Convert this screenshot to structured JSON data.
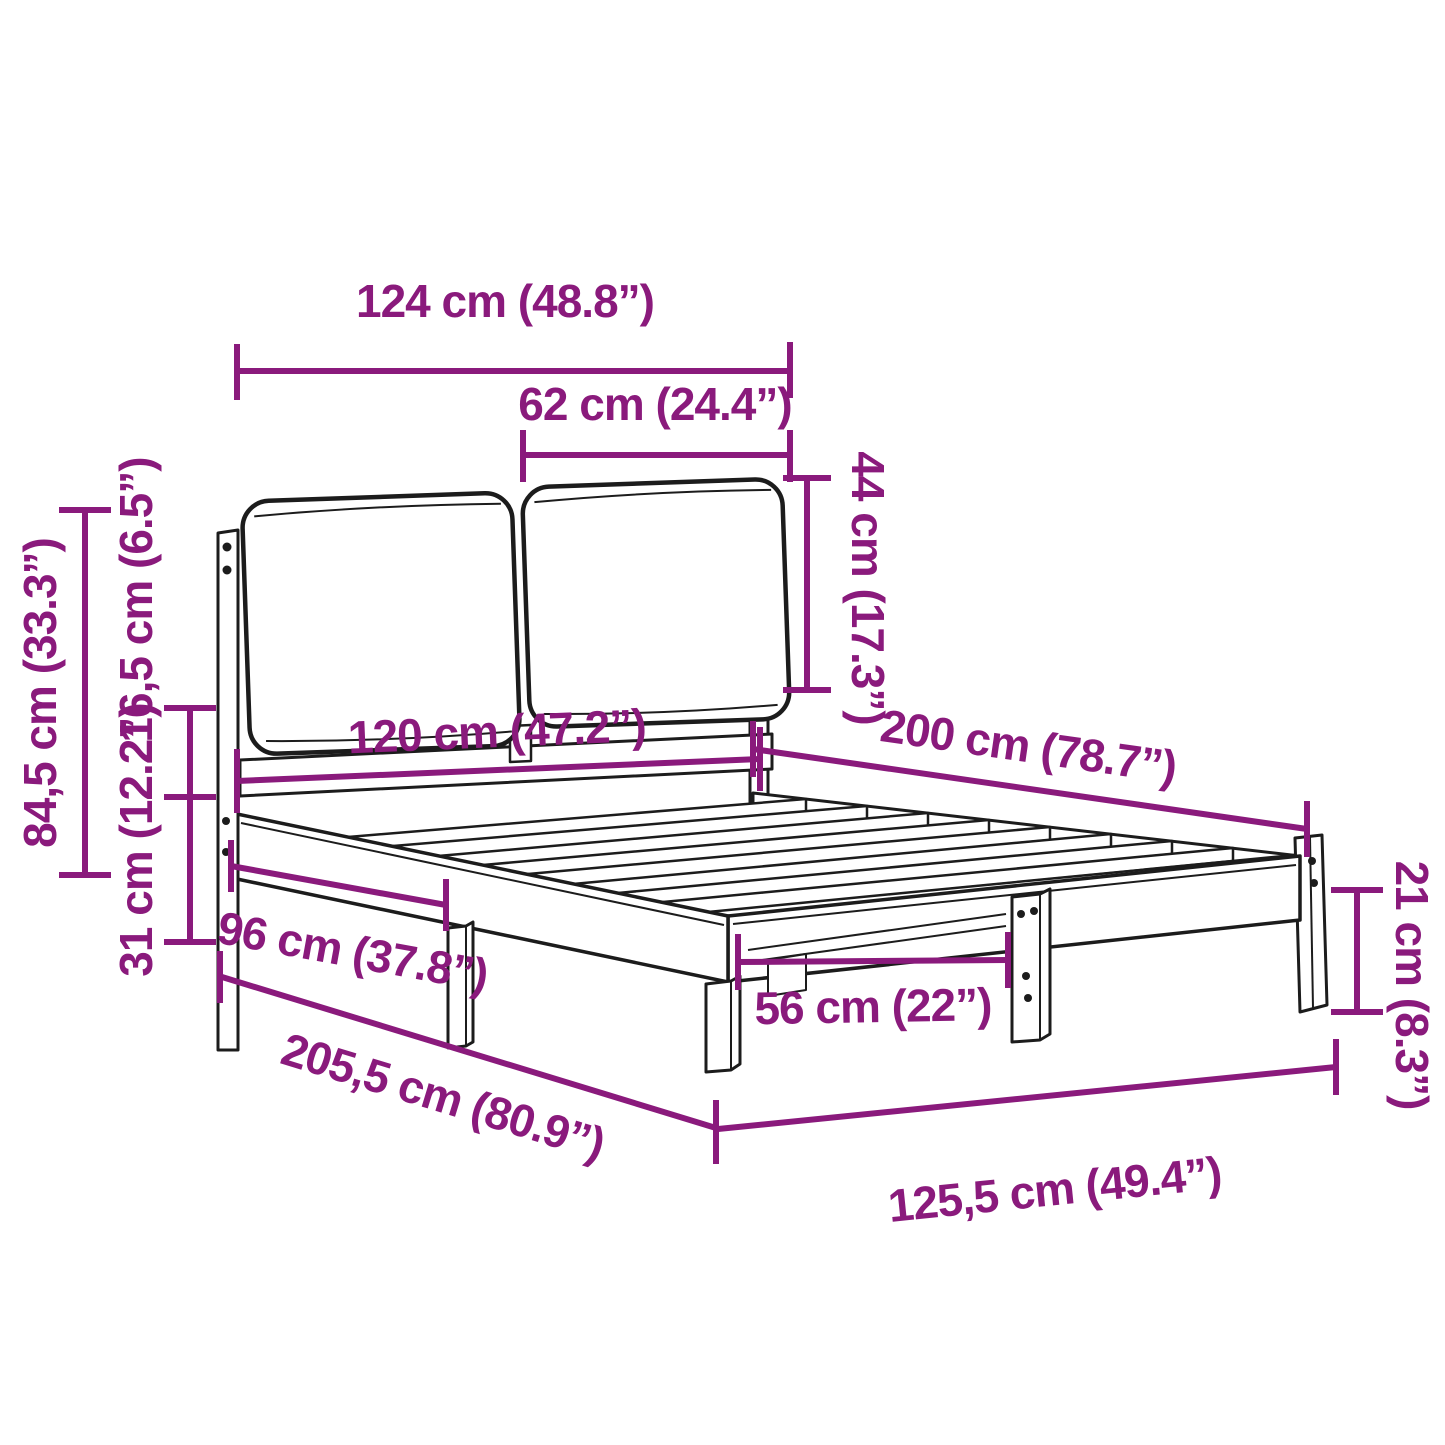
{
  "diagram": {
    "type": "product-dimension-diagram",
    "subject": "bed frame with two-cushion upholstered headboard",
    "colors": {
      "dimension_accent": "#8a1a7c",
      "outline": "#1c1c1c",
      "background": "#ffffff"
    },
    "dimensions": [
      {
        "id": "headboard-total-width",
        "label": "124 cm (48.8”)"
      },
      {
        "id": "cushion-width",
        "label": "62 cm (24.4”)"
      },
      {
        "id": "cushion-height",
        "label": "44 cm (17.3”)"
      },
      {
        "id": "bed-width",
        "label": "120 cm (47.2”)"
      },
      {
        "id": "bed-length",
        "label": "200 cm (78.7”)"
      },
      {
        "id": "headboard-height",
        "label": "84,5 cm (33.3”)"
      },
      {
        "id": "headboard-overhang",
        "label": "16,5 cm (6.5”)"
      },
      {
        "id": "frame-top-height",
        "label": "31 cm (12.2”)"
      },
      {
        "id": "post-to-leg-spacing",
        "label": "96 cm (37.8”)"
      },
      {
        "id": "total-length",
        "label": "205,5 cm (80.9”)"
      },
      {
        "id": "leg-clearance",
        "label": "56 cm (22”)"
      },
      {
        "id": "total-width",
        "label": "125,5 cm (49.4”)"
      },
      {
        "id": "leg-height",
        "label": "21 cm (8.3”)"
      }
    ]
  }
}
